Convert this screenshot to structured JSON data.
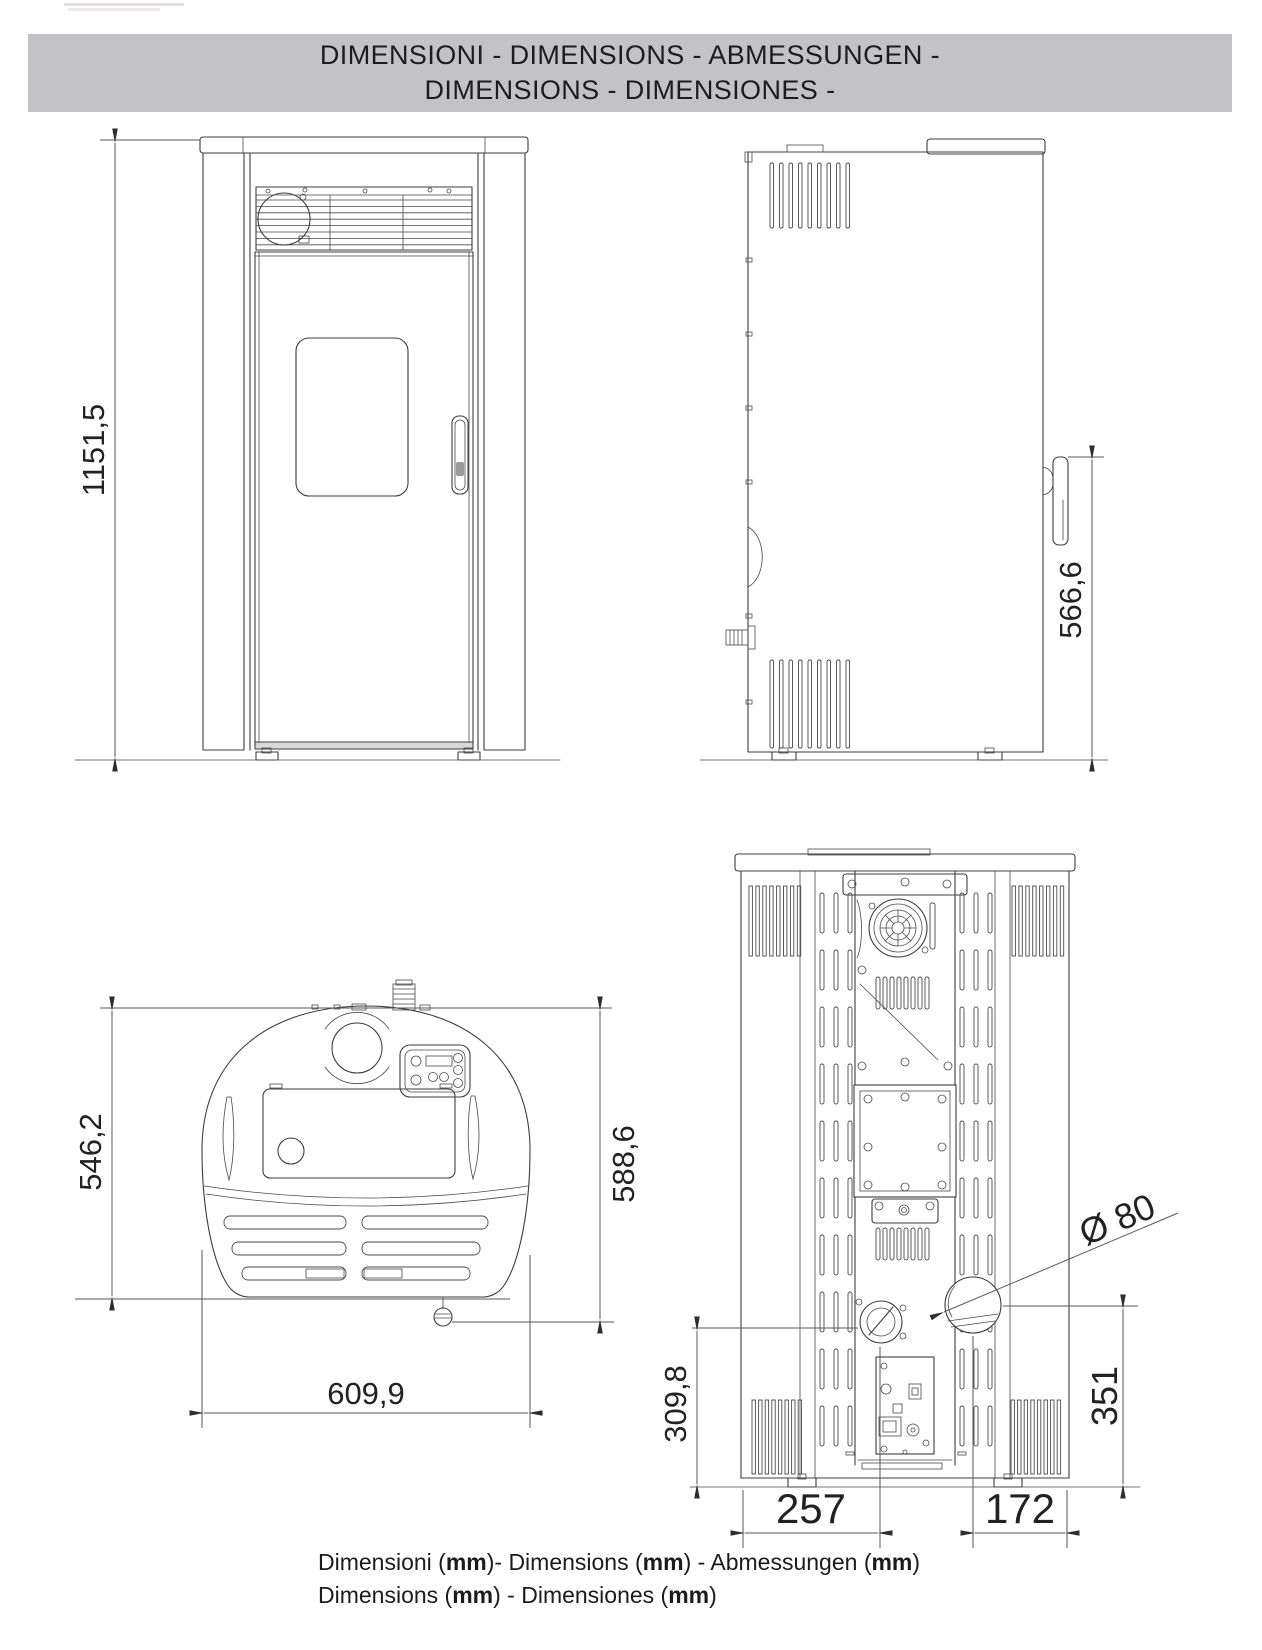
{
  "header": {
    "line1": "DIMENSIONI - DIMENSIONS - ABMESSUNGEN -",
    "line2": "DIMENSIONS - DIMENSIONES -"
  },
  "views": {
    "front": {
      "height_label": "1151,5"
    },
    "side": {
      "handle_height_label": "566,6"
    },
    "top": {
      "body_depth_label": "546,2",
      "total_depth_label": "588,6",
      "width_label": "609,9"
    },
    "rear": {
      "flue_diameter_label": "Ø 80",
      "inlet_center_height_label": "309,8",
      "flue_center_height_label": "351",
      "inlet_center_offset_label": "257",
      "flue_center_offset_label": "172"
    }
  },
  "footer": {
    "line1": [
      "Dimensioni (",
      "mm",
      ")- Dimensions (",
      "mm",
      ") - Abmessungen (",
      "mm",
      ")"
    ],
    "line2": [
      "Dimensions (",
      "mm",
      ") - Dimensiones (",
      "mm",
      ")"
    ]
  },
  "colors": {
    "banner_bg": "#c3c3c5",
    "line_color": "#3d3d3f",
    "text_color": "#1d1d1f"
  }
}
